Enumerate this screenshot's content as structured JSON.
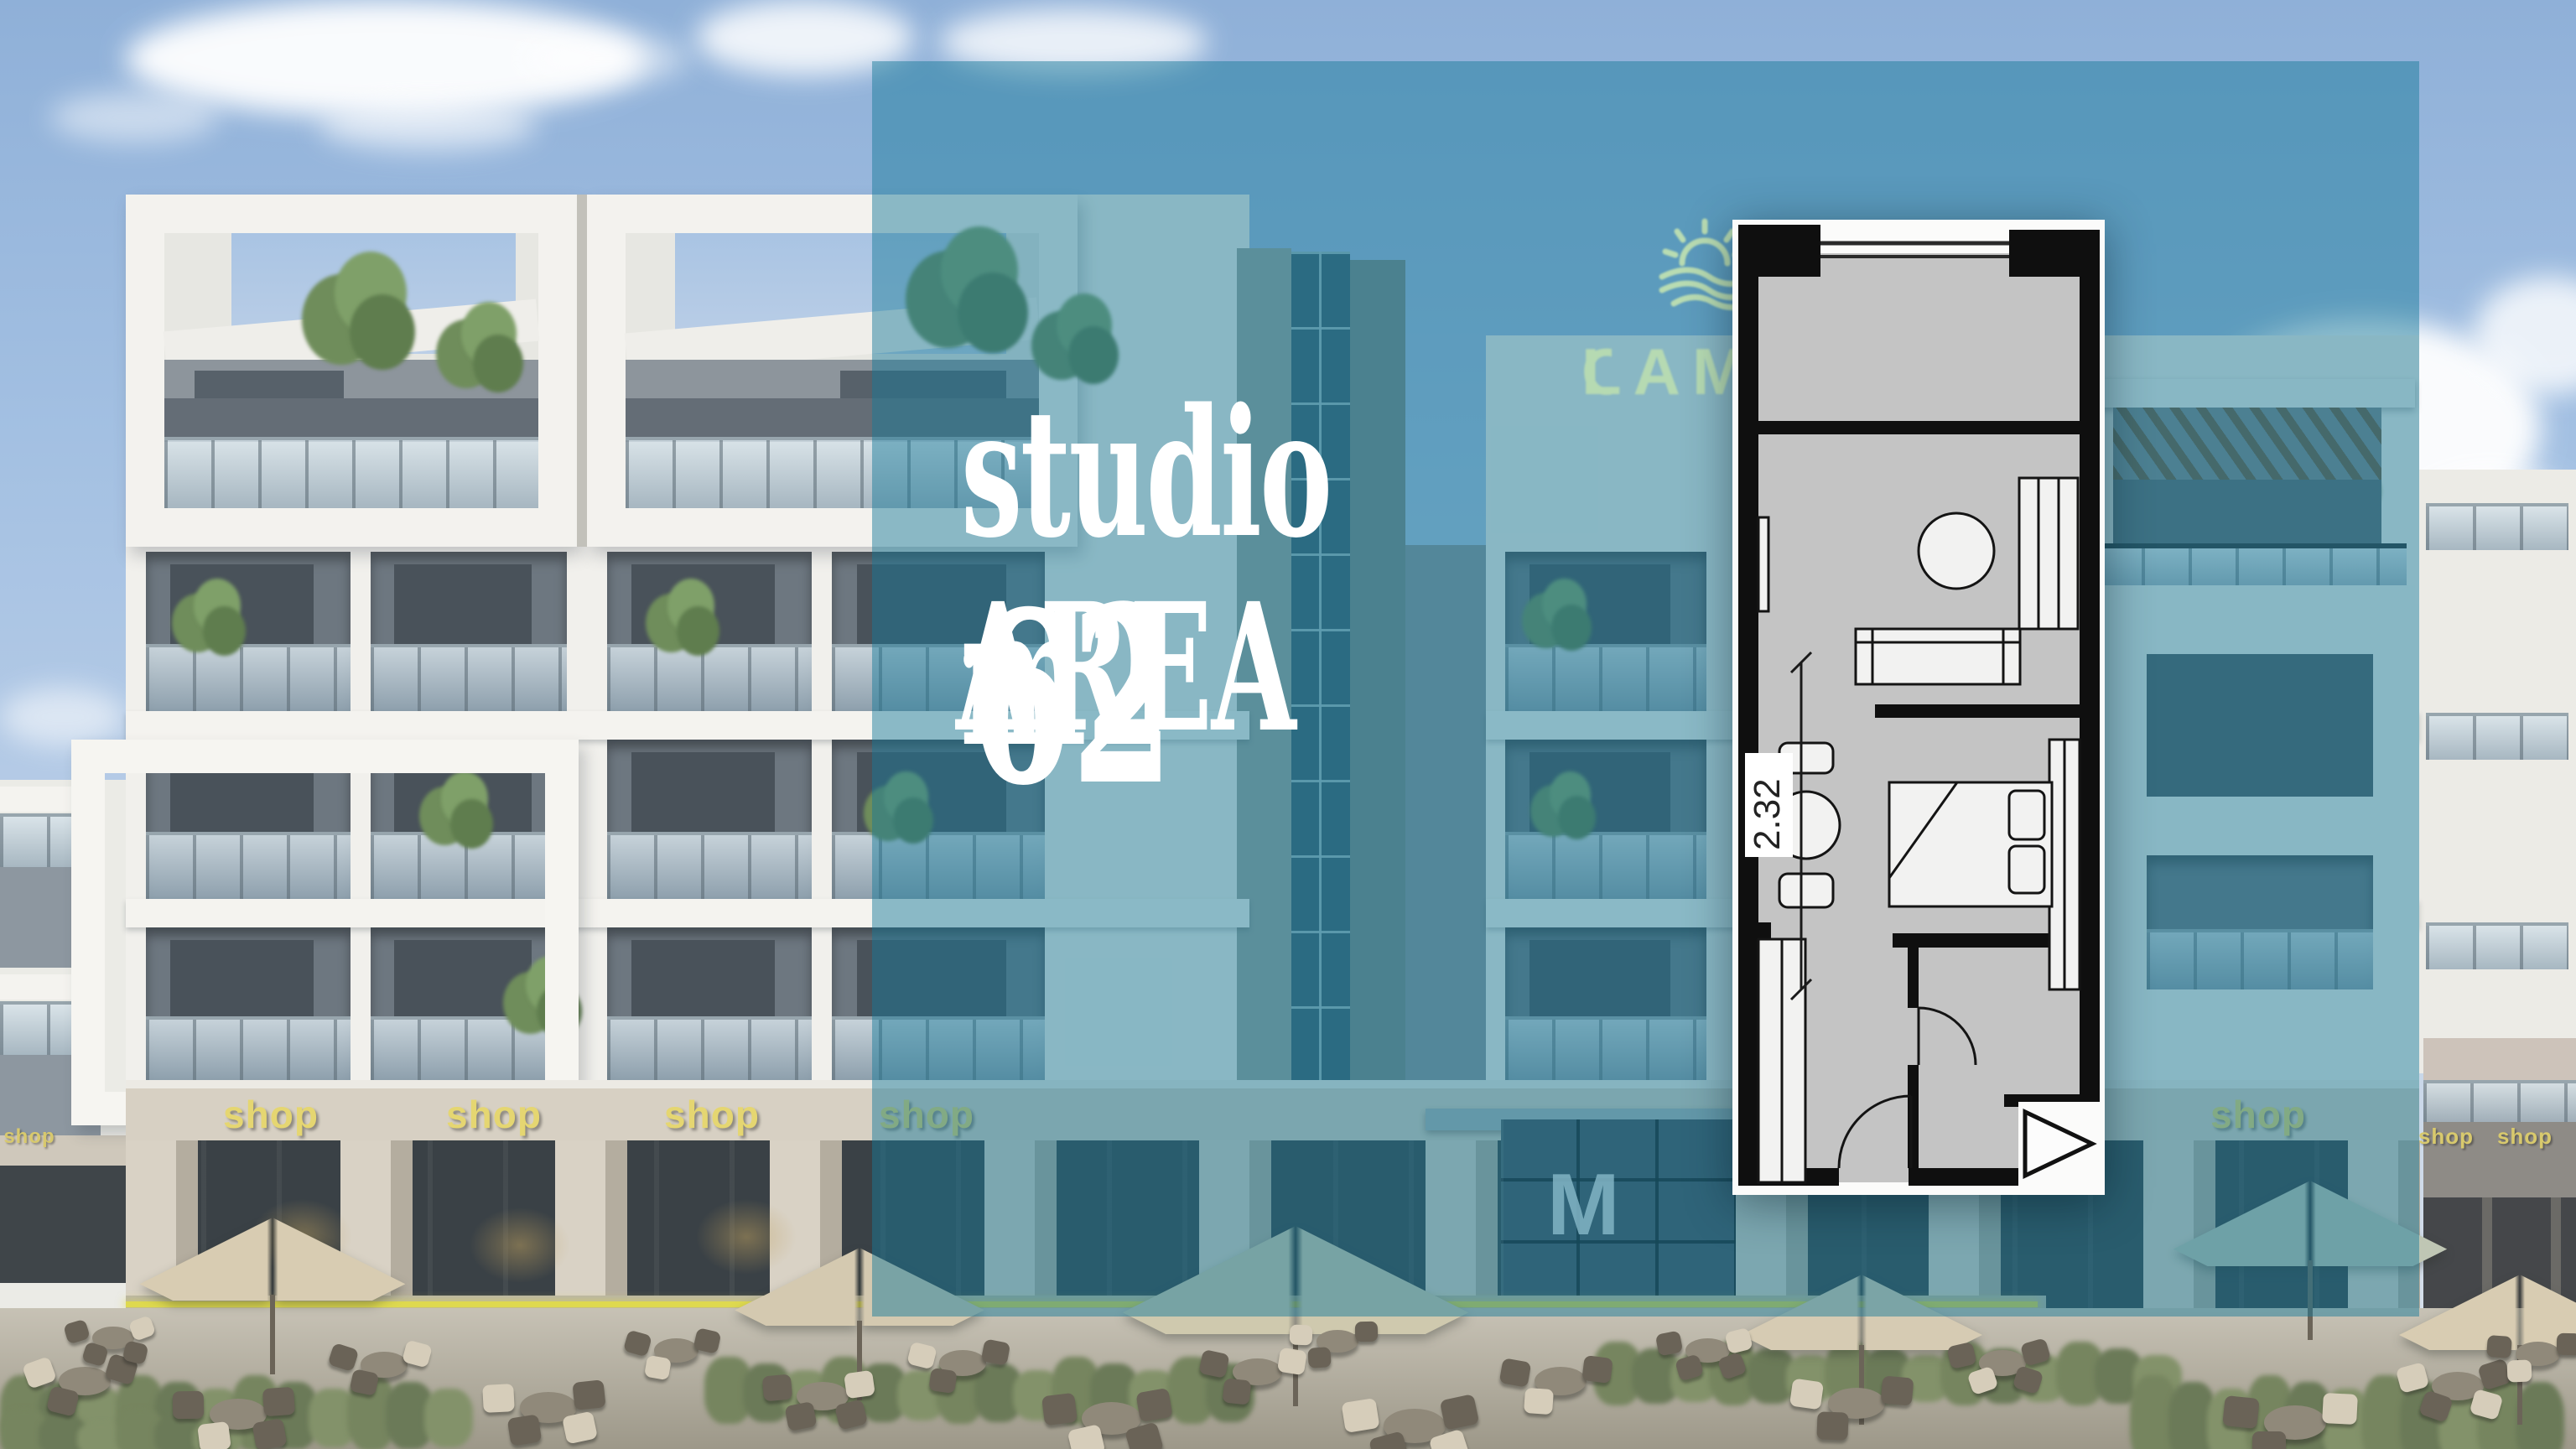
{
  "headline": {
    "line1": "studio",
    "line2_label": "AREA",
    "area_value": "62",
    "separator": ".",
    "area_unit": "m2"
  },
  "logo": {
    "text": "LAM",
    "partial_letter": "O",
    "icon": "sun-over-waves-icon",
    "color": "#b9dcb2"
  },
  "floor_plan": {
    "dimension_label": "2.32"
  },
  "ground_floor": {
    "shop_signs_left": [
      "shop",
      "shop",
      "shop",
      "shop"
    ],
    "shop_sign_right": "shop",
    "shop_signs_far_right": [
      "shop",
      "shop"
    ],
    "shop_sign_left_edge": "shop",
    "entrance_logo": "M"
  },
  "colors": {
    "overlay_teal": "#16798f",
    "headline_white": "#ffffff",
    "shop_sign_yellow": "#e5d671",
    "logo_green": "#b9dcb2",
    "plan_wall_black": "#0f0f0f",
    "plan_floor_gray": "#c4c4c4",
    "sky_blue": "#8fb0d8"
  }
}
